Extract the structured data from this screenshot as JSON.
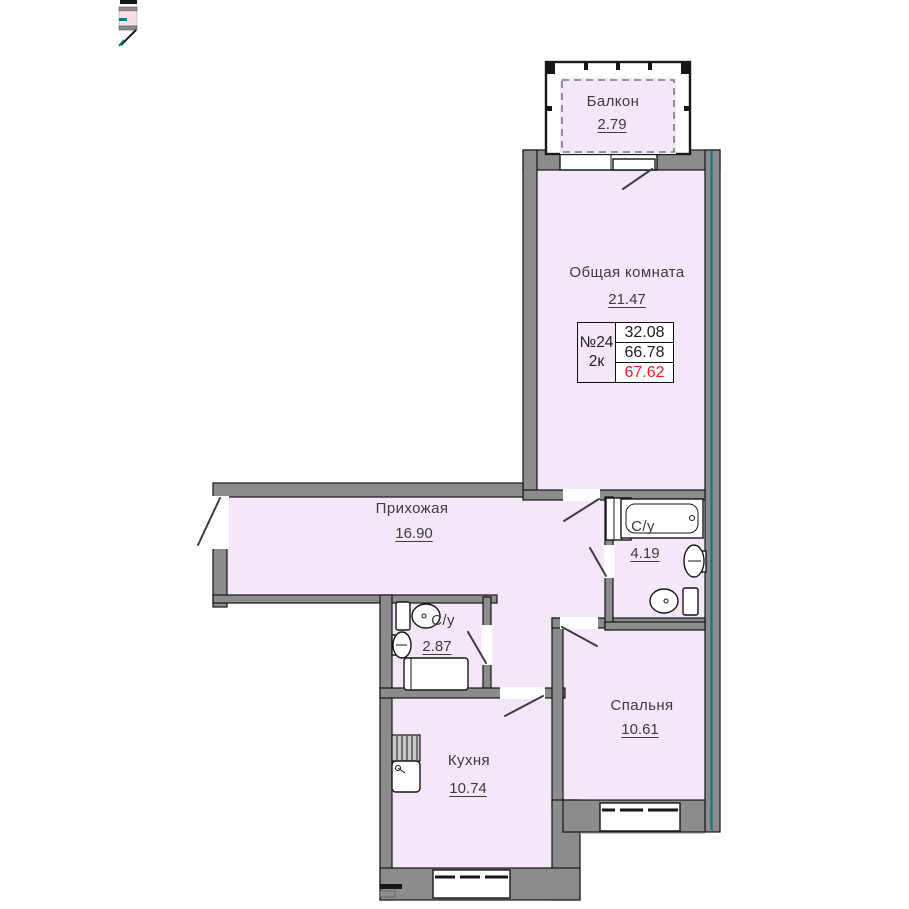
{
  "unit_card": {
    "number": "№24",
    "type": "2к",
    "values": [
      "32.08",
      "66.78",
      "67.62"
    ]
  },
  "rooms": {
    "balcony": {
      "name": "Балкон",
      "area": "2.79"
    },
    "living": {
      "name": "Общая комната",
      "area": "21.47"
    },
    "hallway": {
      "name": "Прихожая",
      "area": "16.90"
    },
    "bathroom": {
      "name": "С/у",
      "area": "4.19"
    },
    "wc": {
      "name": "С/у",
      "area": "2.87"
    },
    "kitchen": {
      "name": "Кухня",
      "area": "10.74"
    },
    "bedroom": {
      "name": "Спальня",
      "area": "10.61"
    }
  },
  "colors": {
    "room_fill": "#f4e8f8",
    "wall_gray": "#8c8c8c",
    "outline_black": "#161616",
    "section_teal": "#0c7b7d",
    "total_area_red": "#ed1c24"
  }
}
